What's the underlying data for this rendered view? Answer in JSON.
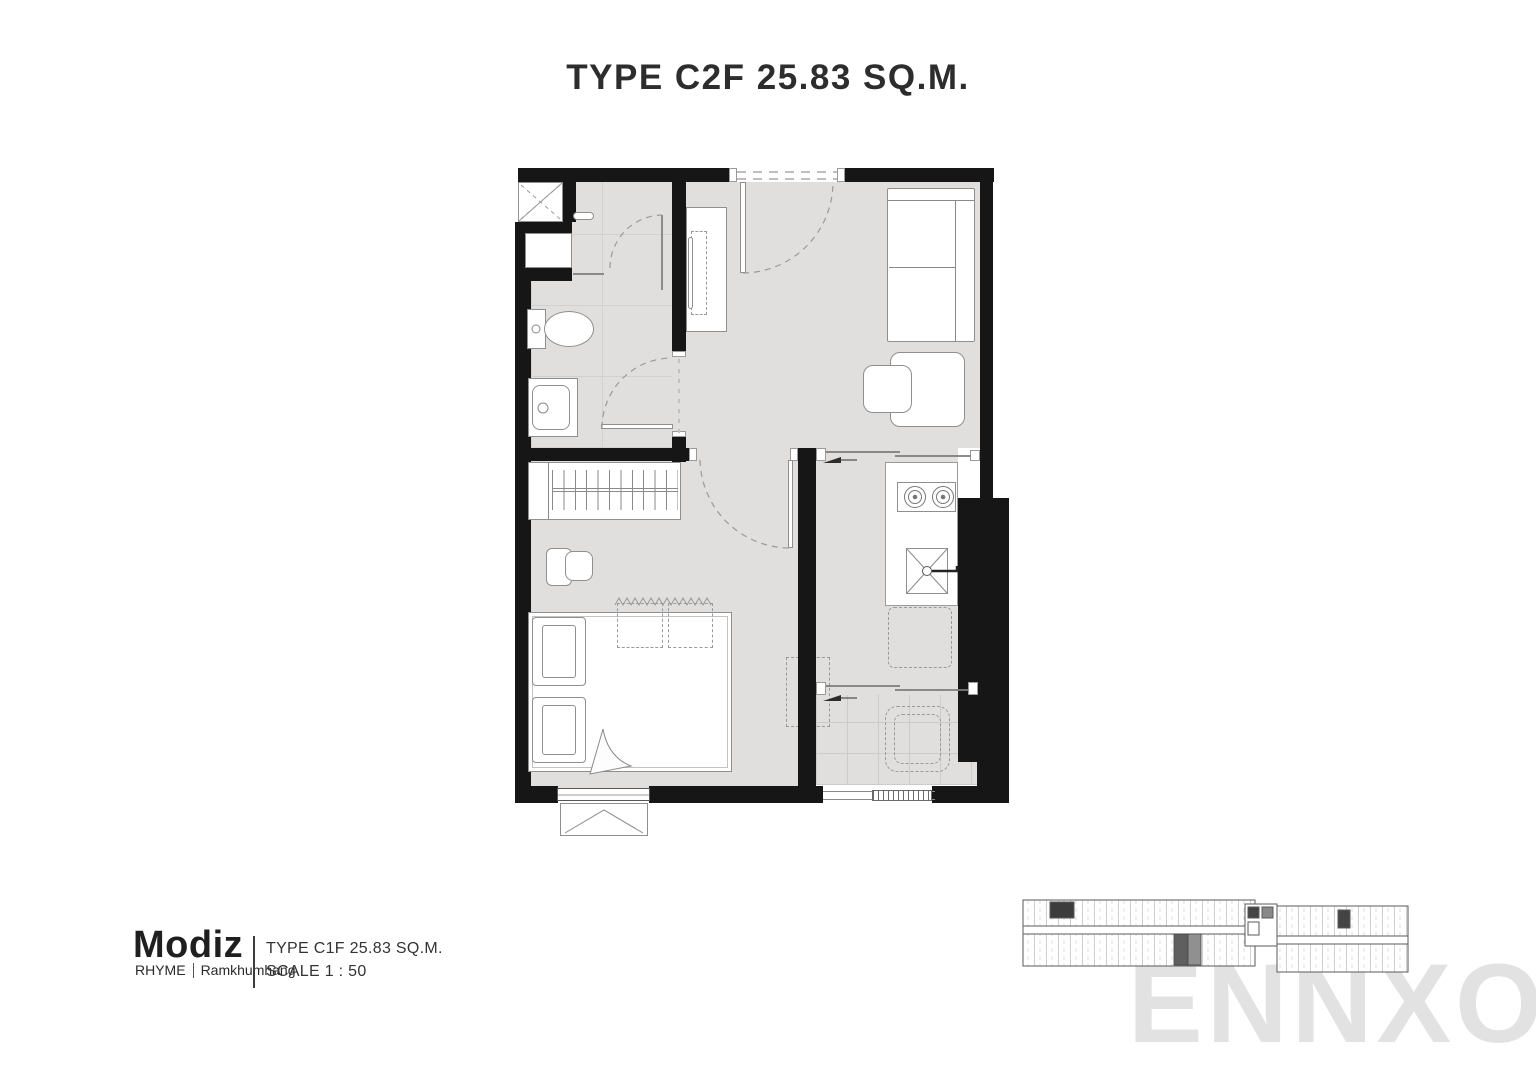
{
  "page": {
    "title": "TYPE C2F 25.83 SQ.M."
  },
  "watermark": {
    "text": "ENNXO"
  },
  "footer": {
    "brand": "Modiz",
    "series": "RHYME",
    "location": "Ramkhumhang",
    "type_label": "TYPE C1F 25.83 SQ.M.",
    "scale_label": "SCALE  1 : 50"
  },
  "key_plan": {
    "description": "building key plan with highlighted unit",
    "highlight_color": "#5f5f5f"
  },
  "colors": {
    "wall": "#161616",
    "floor": "#e1dfde",
    "fixture_line": "#8a8a8a",
    "title_text": "#2d2d2d",
    "watermark": "#e3e2e2"
  }
}
